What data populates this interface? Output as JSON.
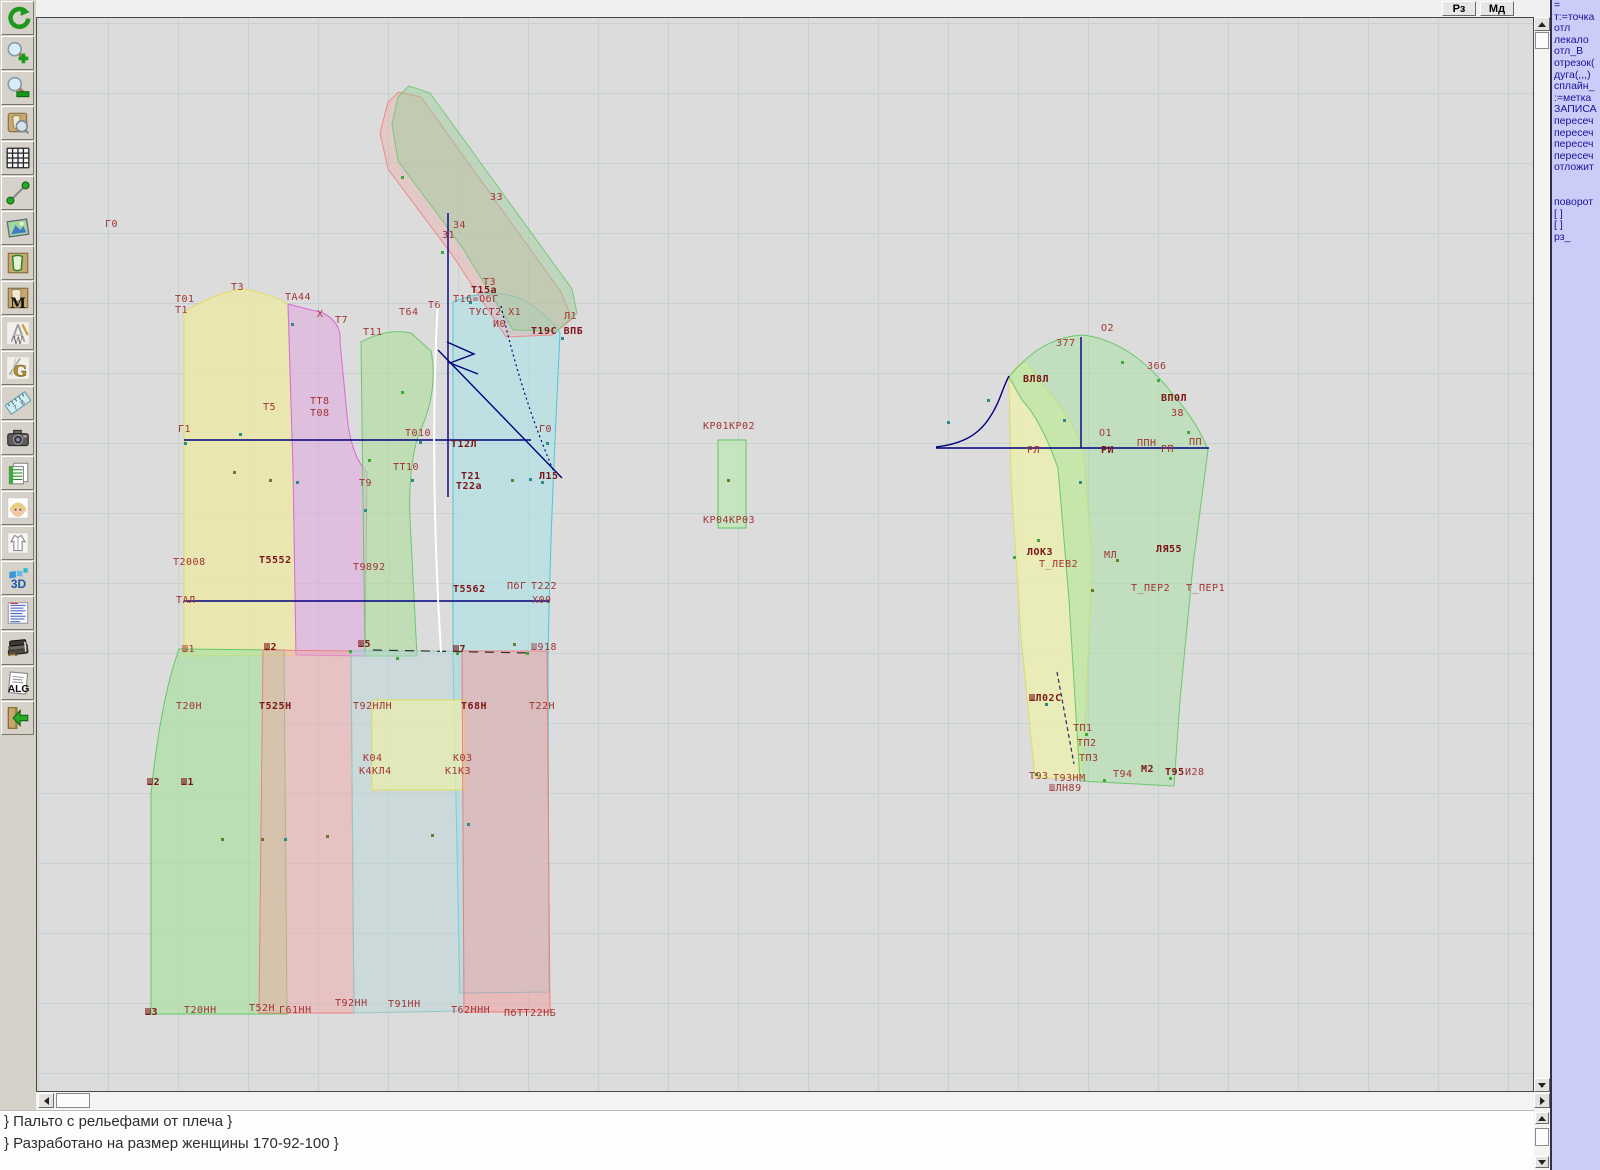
{
  "topbar": {
    "buttons": [
      {
        "label": "Рз"
      },
      {
        "label": "Мд"
      }
    ]
  },
  "toolbar": {
    "icons": [
      {
        "name": "refresh"
      },
      {
        "name": "zoom-in"
      },
      {
        "name": "zoom-out"
      },
      {
        "name": "view-piece"
      },
      {
        "name": "grid"
      },
      {
        "name": "measure-segment"
      },
      {
        "name": "image"
      },
      {
        "name": "pattern-outline"
      },
      {
        "name": "pattern-m",
        "label": "M"
      },
      {
        "name": "drafting",
        "label": "W"
      },
      {
        "name": "letter-g",
        "label": "G"
      },
      {
        "name": "ruler",
        "l1": "7",
        "l2": "8"
      },
      {
        "name": "camera"
      },
      {
        "name": "spreadsheet"
      },
      {
        "name": "portrait"
      },
      {
        "name": "garment"
      },
      {
        "name": "three-d",
        "label": "3D"
      },
      {
        "name": "list-document"
      },
      {
        "name": "books"
      },
      {
        "name": "alg",
        "label": "ALG"
      },
      {
        "name": "exit"
      }
    ]
  },
  "right_panel": {
    "items": [
      "=",
      "т:=точка",
      "отл",
      "лекало",
      "отл_В",
      "отрезок(",
      "дуга(,,,)",
      "сплайн_",
      ":=метка",
      "ЗАПИСА",
      "пересеч",
      "пересеч",
      "пересеч",
      "пересеч",
      "отложит",
      "",
      "",
      "поворот",
      "[ ]",
      "[ ]",
      "рз_"
    ]
  },
  "statusbar": {
    "lines": [
      "} Пальто с рельефами от плеча }",
      "} Разработано на размер женщины 170-92-100 }"
    ]
  },
  "canvas": {
    "point_colors": [
      "#6b7a2a",
      "#2a8a8a",
      "#3aaa3a"
    ],
    "labels": [
      {
        "t": "Г0",
        "x": 104,
        "y": 218
      },
      {
        "t": "Т3",
        "x": 230,
        "y": 281
      },
      {
        "t": "Т01",
        "x": 174,
        "y": 293
      },
      {
        "t": "Т1",
        "x": 174,
        "y": 304
      },
      {
        "t": "ТА44",
        "x": 284,
        "y": 291
      },
      {
        "t": "Х",
        "x": 316,
        "y": 308
      },
      {
        "t": "Т7",
        "x": 334,
        "y": 314
      },
      {
        "t": "Т11",
        "x": 362,
        "y": 326
      },
      {
        "t": "З3",
        "x": 489,
        "y": 191
      },
      {
        "t": "З4",
        "x": 452,
        "y": 219
      },
      {
        "t": "З1",
        "x": 441,
        "y": 229
      },
      {
        "t": "Т3",
        "x": 482,
        "y": 276
      },
      {
        "t": "Т15а",
        "x": 470,
        "y": 284,
        "b": 1
      },
      {
        "t": "Т16=ОбГ",
        "x": 452,
        "y": 293
      },
      {
        "t": "Т6",
        "x": 427,
        "y": 299
      },
      {
        "t": "Т64",
        "x": 398,
        "y": 306
      },
      {
        "t": "ТУСТ2 Х1",
        "x": 468,
        "y": 306
      },
      {
        "t": "И0",
        "x": 492,
        "y": 318
      },
      {
        "t": "Л1",
        "x": 563,
        "y": 310
      },
      {
        "t": "Т19С ВПБ",
        "x": 530,
        "y": 325,
        "b": 1
      },
      {
        "t": "Т5",
        "x": 262,
        "y": 401
      },
      {
        "t": "ТТ8",
        "x": 309,
        "y": 395
      },
      {
        "t": "Т08",
        "x": 309,
        "y": 407
      },
      {
        "t": "Г1",
        "x": 177,
        "y": 423
      },
      {
        "t": "Т010",
        "x": 404,
        "y": 427
      },
      {
        "t": "Т12Л",
        "x": 450,
        "y": 438,
        "b": 1
      },
      {
        "t": "Г0",
        "x": 538,
        "y": 423
      },
      {
        "t": "ТТ10",
        "x": 392,
        "y": 461
      },
      {
        "t": "Т9",
        "x": 358,
        "y": 477
      },
      {
        "t": "Т21",
        "x": 460,
        "y": 470,
        "b": 1
      },
      {
        "t": "Т22а",
        "x": 455,
        "y": 480,
        "b": 1
      },
      {
        "t": "Л15",
        "x": 538,
        "y": 470,
        "b": 1
      },
      {
        "t": "Т2008",
        "x": 172,
        "y": 556
      },
      {
        "t": "Т5552",
        "x": 258,
        "y": 554,
        "b": 1
      },
      {
        "t": "Т9892",
        "x": 352,
        "y": 561
      },
      {
        "t": "ТАЛ",
        "x": 175,
        "y": 594
      },
      {
        "t": "Т5562",
        "x": 452,
        "y": 583,
        "b": 1
      },
      {
        "t": "ПбГ",
        "x": 506,
        "y": 580
      },
      {
        "t": "Т222",
        "x": 530,
        "y": 580
      },
      {
        "t": "Х00",
        "x": 531,
        "y": 594
      },
      {
        "t": "Ш1",
        "x": 181,
        "y": 643
      },
      {
        "t": "Ш2",
        "x": 263,
        "y": 641,
        "b": 1
      },
      {
        "t": "Ш5",
        "x": 357,
        "y": 638,
        "b": 1
      },
      {
        "t": "Ш7",
        "x": 452,
        "y": 643,
        "b": 1
      },
      {
        "t": "Ш918",
        "x": 530,
        "y": 641
      },
      {
        "t": "Т20Н",
        "x": 175,
        "y": 700
      },
      {
        "t": "Т525Н",
        "x": 258,
        "y": 700,
        "b": 1
      },
      {
        "t": "Т92НЛН",
        "x": 352,
        "y": 700
      },
      {
        "t": "Т68Н",
        "x": 460,
        "y": 700,
        "b": 1
      },
      {
        "t": "Т22Н",
        "x": 528,
        "y": 700
      },
      {
        "t": "К04",
        "x": 362,
        "y": 752
      },
      {
        "t": "К03",
        "x": 452,
        "y": 752
      },
      {
        "t": "К4КЛ4",
        "x": 358,
        "y": 765
      },
      {
        "t": "К1КЗ",
        "x": 444,
        "y": 765
      },
      {
        "t": "Ш2",
        "x": 146,
        "y": 776,
        "b": 1
      },
      {
        "t": "Ш1",
        "x": 180,
        "y": 776,
        "b": 1
      },
      {
        "t": "Ш3",
        "x": 144,
        "y": 1006,
        "b": 1
      },
      {
        "t": "Т20НН",
        "x": 183,
        "y": 1004
      },
      {
        "t": "Т52Н",
        "x": 248,
        "y": 1002
      },
      {
        "t": "Г61НН",
        "x": 278,
        "y": 1004
      },
      {
        "t": "Т92НН",
        "x": 334,
        "y": 997
      },
      {
        "t": "Т91НН",
        "x": 387,
        "y": 998
      },
      {
        "t": "Т62ННН",
        "x": 450,
        "y": 1004
      },
      {
        "t": "ПбТТ22НБ",
        "x": 503,
        "y": 1007
      },
      {
        "t": "КР01",
        "x": 702,
        "y": 420
      },
      {
        "t": "КР02",
        "x": 728,
        "y": 420
      },
      {
        "t": "КР04",
        "x": 702,
        "y": 514
      },
      {
        "t": "КР03",
        "x": 728,
        "y": 514
      },
      {
        "t": "О2",
        "x": 1100,
        "y": 322
      },
      {
        "t": "З77",
        "x": 1055,
        "y": 337
      },
      {
        "t": "З66",
        "x": 1146,
        "y": 360
      },
      {
        "t": "ВЛ8Л",
        "x": 1022,
        "y": 373,
        "b": 1
      },
      {
        "t": "ВП0Л",
        "x": 1160,
        "y": 392,
        "b": 1
      },
      {
        "t": "38",
        "x": 1170,
        "y": 407
      },
      {
        "t": "О1",
        "x": 1098,
        "y": 427
      },
      {
        "t": "РЛ",
        "x": 1026,
        "y": 444
      },
      {
        "t": "РИ",
        "x": 1100,
        "y": 444,
        "b": 1
      },
      {
        "t": "ППН",
        "x": 1136,
        "y": 437
      },
      {
        "t": "РП",
        "x": 1160,
        "y": 443
      },
      {
        "t": "ПП",
        "x": 1188,
        "y": 436
      },
      {
        "t": "ЛОК3",
        "x": 1026,
        "y": 546,
        "b": 1
      },
      {
        "t": "Т_ЛЕВ2",
        "x": 1038,
        "y": 558
      },
      {
        "t": "МЛ",
        "x": 1103,
        "y": 549
      },
      {
        "t": "ЛЯ55",
        "x": 1155,
        "y": 543,
        "b": 1
      },
      {
        "t": "Т_ПЕР2",
        "x": 1130,
        "y": 582
      },
      {
        "t": "Т_ПЕР1",
        "x": 1185,
        "y": 582
      },
      {
        "t": "ШЛ02С",
        "x": 1028,
        "y": 692,
        "b": 1
      },
      {
        "t": "ТП1",
        "x": 1072,
        "y": 722
      },
      {
        "t": "ТП2",
        "x": 1076,
        "y": 737
      },
      {
        "t": "ТП3",
        "x": 1078,
        "y": 752
      },
      {
        "t": "Т93",
        "x": 1028,
        "y": 770
      },
      {
        "t": "Т93НМ",
        "x": 1052,
        "y": 772
      },
      {
        "t": "Т94",
        "x": 1112,
        "y": 768
      },
      {
        "t": "М2",
        "x": 1140,
        "y": 763,
        "b": 1
      },
      {
        "t": "Т95",
        "x": 1164,
        "y": 766,
        "b": 1
      },
      {
        "t": "И28",
        "x": 1184,
        "y": 766
      },
      {
        "t": "ШЛН89",
        "x": 1048,
        "y": 782
      }
    ],
    "points": [
      {
        "x": 232,
        "y": 470,
        "c": 0
      },
      {
        "x": 268,
        "y": 478,
        "c": 0
      },
      {
        "x": 363,
        "y": 508,
        "c": 1
      },
      {
        "x": 410,
        "y": 478,
        "c": 1
      },
      {
        "x": 430,
        "y": 833,
        "c": 0
      },
      {
        "x": 466,
        "y": 822,
        "c": 1
      },
      {
        "x": 510,
        "y": 478,
        "c": 0
      },
      {
        "x": 540,
        "y": 480,
        "c": 1
      },
      {
        "x": 220,
        "y": 837,
        "c": 0
      },
      {
        "x": 260,
        "y": 837,
        "c": 0
      },
      {
        "x": 283,
        "y": 837,
        "c": 1
      },
      {
        "x": 325,
        "y": 834,
        "c": 0
      },
      {
        "x": 400,
        "y": 390,
        "c": 2
      },
      {
        "x": 367,
        "y": 458,
        "c": 2
      },
      {
        "x": 528,
        "y": 477,
        "c": 1
      },
      {
        "x": 512,
        "y": 642,
        "c": 0
      },
      {
        "x": 726,
        "y": 478,
        "c": 0
      },
      {
        "x": 1012,
        "y": 555,
        "c": 2
      },
      {
        "x": 1036,
        "y": 538,
        "c": 2
      },
      {
        "x": 1090,
        "y": 588,
        "c": 0
      },
      {
        "x": 1115,
        "y": 558,
        "c": 0
      },
      {
        "x": 1078,
        "y": 480,
        "c": 1
      },
      {
        "x": 946,
        "y": 420,
        "c": 1
      },
      {
        "x": 986,
        "y": 398,
        "c": 1
      },
      {
        "x": 1062,
        "y": 418,
        "c": 1
      },
      {
        "x": 1120,
        "y": 360,
        "c": 2
      },
      {
        "x": 1156,
        "y": 378,
        "c": 2
      },
      {
        "x": 1186,
        "y": 430,
        "c": 2
      },
      {
        "x": 1044,
        "y": 702,
        "c": 1
      },
      {
        "x": 1084,
        "y": 732,
        "c": 2
      },
      {
        "x": 440,
        "y": 250,
        "c": 2
      },
      {
        "x": 400,
        "y": 175,
        "c": 2
      },
      {
        "x": 468,
        "y": 300,
        "c": 1
      },
      {
        "x": 560,
        "y": 336,
        "c": 1
      },
      {
        "x": 290,
        "y": 322,
        "c": 1
      },
      {
        "x": 418,
        "y": 440,
        "c": 1
      },
      {
        "x": 238,
        "y": 432,
        "c": 1
      },
      {
        "x": 295,
        "y": 480,
        "c": 1
      },
      {
        "x": 348,
        "y": 649,
        "c": 2
      },
      {
        "x": 395,
        "y": 656,
        "c": 2
      },
      {
        "x": 455,
        "y": 651,
        "c": 2
      },
      {
        "x": 525,
        "y": 651,
        "c": 2
      },
      {
        "x": 183,
        "y": 441,
        "c": 1
      },
      {
        "x": 545,
        "y": 441,
        "c": 1
      },
      {
        "x": 1034,
        "y": 772,
        "c": 2
      },
      {
        "x": 1102,
        "y": 778,
        "c": 2
      },
      {
        "x": 1168,
        "y": 776,
        "c": 2
      }
    ]
  }
}
